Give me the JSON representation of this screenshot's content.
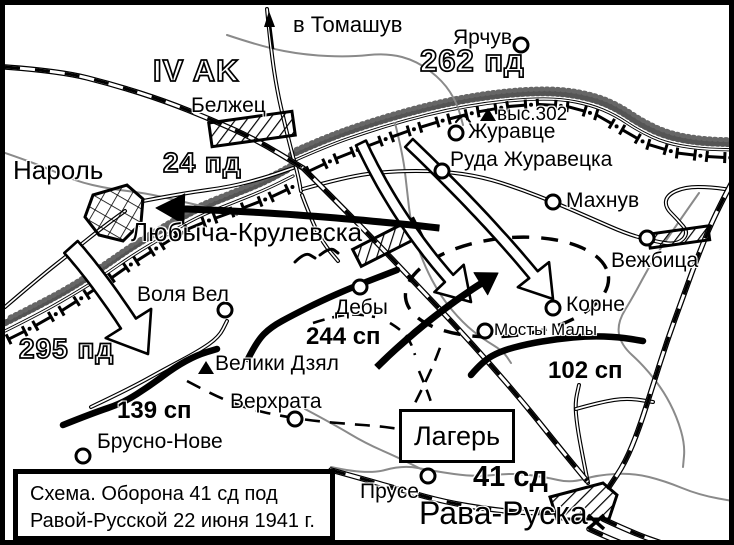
{
  "colors": {
    "ink": "#000000",
    "river": "#8a8a8a",
    "paper": "#ffffff"
  },
  "caption": {
    "line1": "Схема. Оборона 41 сд под",
    "line2": "Равой-Русской 22 июня 1941 г."
  },
  "camp_box": {
    "label": "Лагерь"
  },
  "direction_sign": {
    "id": "to-tomashuv",
    "label": "в Томашув",
    "x": 288,
    "y": 9
  },
  "german_units": [
    {
      "id": "iv-ak",
      "label": "IV AK",
      "x": 148,
      "y": 50,
      "style": "lg"
    },
    {
      "id": "262-pd",
      "label": "262 пд",
      "x": 415,
      "y": 40,
      "style": "lg"
    },
    {
      "id": "24-pd",
      "label": "24 пд",
      "x": 158,
      "y": 144,
      "style": "md"
    },
    {
      "id": "295-pd",
      "label": "295 пд",
      "x": 14,
      "y": 330,
      "style": "md"
    }
  ],
  "soviet_units": [
    {
      "id": "244-sp",
      "label": "244 сп",
      "x": 301,
      "y": 320,
      "style": "md"
    },
    {
      "id": "139-sp",
      "label": "139 сп",
      "x": 112,
      "y": 394,
      "style": "md"
    },
    {
      "id": "102-sp",
      "label": "102 сп",
      "x": 543,
      "y": 354,
      "style": "md"
    },
    {
      "id": "41-sd",
      "label": "41 сд",
      "x": 468,
      "y": 458,
      "style": "lg"
    }
  ],
  "settlements": [
    {
      "id": "narol",
      "label": "Нароль",
      "x": 8,
      "y": 152,
      "style": "lg"
    },
    {
      "id": "belzhec",
      "label": "Белжец",
      "x": 186,
      "y": 90,
      "style": "md"
    },
    {
      "id": "yarchuv",
      "label": "Ярчув",
      "x": 448,
      "y": 22,
      "style": "md",
      "cx": 516,
      "cy": 40
    },
    {
      "id": "zhuravce",
      "label": "Журавце",
      "x": 463,
      "y": 116,
      "style": "md",
      "cx": 451,
      "cy": 128
    },
    {
      "id": "ruda-zhuravecka",
      "label": "Руда Журавецка",
      "x": 445,
      "y": 144,
      "style": "md",
      "cx": 437,
      "cy": 166
    },
    {
      "id": "mahnuv",
      "label": "Махнув",
      "x": 561,
      "y": 185,
      "style": "md",
      "cx": 548,
      "cy": 197
    },
    {
      "id": "vezhbica",
      "label": "Вежбица",
      "x": 606,
      "y": 245,
      "style": "md",
      "cx": 642,
      "cy": 233
    },
    {
      "id": "korne",
      "label": "Корне",
      "x": 561,
      "y": 289,
      "style": "md",
      "cx": 548,
      "cy": 303
    },
    {
      "id": "mosty-maly",
      "label": "Мосты Малы",
      "x": 489,
      "y": 316,
      "style": "sm",
      "cx": 480,
      "cy": 326
    },
    {
      "id": "deby",
      "label": "Дебы",
      "x": 330,
      "y": 292,
      "style": "md",
      "cx": 355,
      "cy": 282
    },
    {
      "id": "volya-vel",
      "label": "Воля Вел",
      "x": 132,
      "y": 279,
      "style": "md",
      "cx": 220,
      "cy": 305
    },
    {
      "id": "lyubycha-krulevska",
      "label": "Любыча-Крулевска",
      "x": 126,
      "y": 214,
      "style": "lg"
    },
    {
      "id": "veliki-dzyal",
      "label": "Велики Дзял",
      "x": 210,
      "y": 348,
      "style": "md",
      "triangle": [
        201,
        364
      ]
    },
    {
      "id": "verhrata",
      "label": "Верхрата",
      "x": 225,
      "y": 386,
      "style": "md",
      "cx": 290,
      "cy": 414
    },
    {
      "id": "brusno-nove",
      "label": "Брусно-Нове",
      "x": 92,
      "y": 426,
      "style": "md",
      "cx": 78,
      "cy": 451
    },
    {
      "id": "pruse",
      "label": "Прусе",
      "x": 355,
      "y": 476,
      "style": "md",
      "cx": 423,
      "cy": 471
    },
    {
      "id": "rava-ruska",
      "label": "Рава-Руска",
      "x": 414,
      "y": 492,
      "style": "city"
    }
  ],
  "height_marks": [
    {
      "id": "vys-302",
      "label": "выс.302",
      "x": 492,
      "y": 100,
      "triangle": [
        483,
        111
      ]
    }
  ]
}
